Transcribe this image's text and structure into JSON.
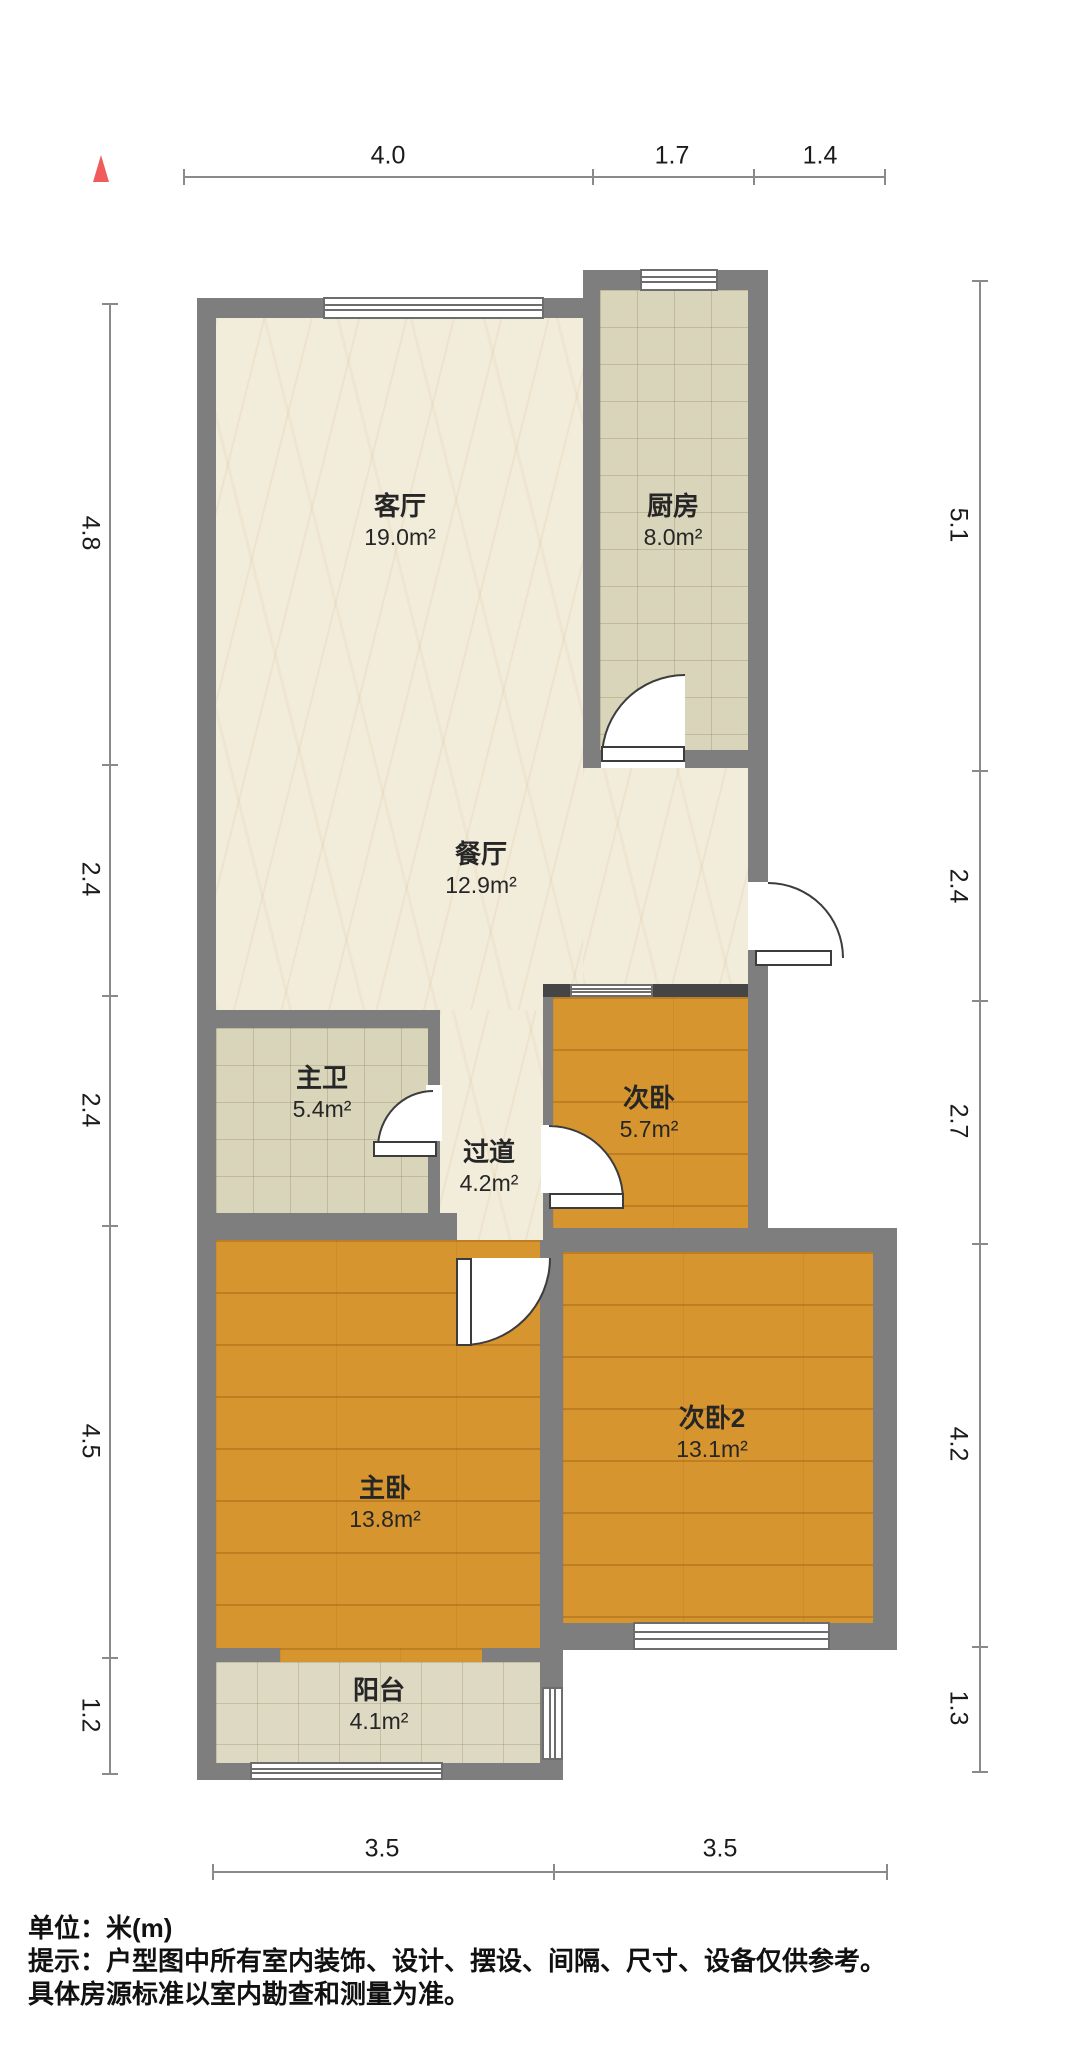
{
  "dimensions": {
    "top": [
      "4.0",
      "1.7",
      "1.4"
    ],
    "left": [
      "4.8",
      "2.4",
      "2.4",
      "4.5",
      "1.2"
    ],
    "right": [
      "5.1",
      "2.4",
      "2.7",
      "4.2",
      "1.3"
    ],
    "bottom": [
      "3.5",
      "3.5"
    ]
  },
  "rooms": [
    {
      "name": "客厅",
      "area": "19.0m²"
    },
    {
      "name": "厨房",
      "area": "8.0m²"
    },
    {
      "name": "餐厅",
      "area": "12.9m²"
    },
    {
      "name": "主卫",
      "area": "5.4m²"
    },
    {
      "name": "过道",
      "area": "4.2m²"
    },
    {
      "name": "次卧",
      "area": "5.7m²"
    },
    {
      "name": "主卧",
      "area": "13.8m²"
    },
    {
      "name": "次卧2",
      "area": "13.1m²"
    },
    {
      "name": "阳台",
      "area": "4.1m²"
    }
  ],
  "footer": {
    "unit_label": "单位：米(m)",
    "note_line1": "提示：户型图中所有室内装饰、设计、摆设、间隔、尺寸、设备仅供参考。",
    "note_line2": "具体房源标准以室内勘查和测量为准。"
  }
}
